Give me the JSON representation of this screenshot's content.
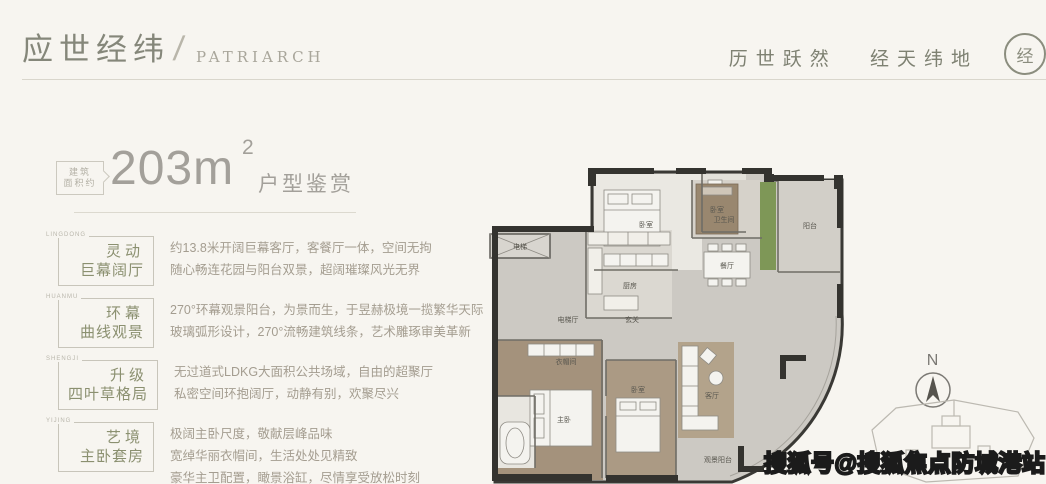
{
  "header": {
    "brand_cn": "应世经纬",
    "brand_slash": "/",
    "brand_en": "PATRIARCH",
    "slogan_part1": "历世跃然",
    "slogan_part2": "经天纬地",
    "seal_char": "经"
  },
  "area": {
    "bubble_line1": "建筑",
    "bubble_line2": "面积约",
    "value": "203m",
    "sup": "2",
    "suffix": "户型鉴赏"
  },
  "sections": [
    {
      "tag": "LINGDONG",
      "title_line1": "灵动",
      "title_line2": "巨幕阔厅",
      "desc": [
        "约13.8米开阔巨幕客厅，客餐厅一体，空间无拘",
        "随心畅连花园与阳台双景，超阔璀璨风光无界"
      ]
    },
    {
      "tag": "HUANMU",
      "title_line1": "环幕",
      "title_line2": "曲线观景",
      "desc": [
        "270°环幕观景阳台，为景而生，于昱赫极境一揽繁华天际",
        "玻璃弧形设计，270°流畅建筑线条，艺术雕琢审美革新"
      ]
    },
    {
      "tag": "SHENGJI",
      "title_line1": "升级",
      "title_line2": "四叶草格局",
      "desc": [
        "无过道式LDKG大面积公共场域，自由的超聚厅",
        "私密空间环抱阔厅，动静有别，欢聚尽兴"
      ]
    },
    {
      "tag": "YIJING",
      "title_line1": "艺境",
      "title_line2": "主卧套房",
      "desc": [
        "极阔主卧尺度，敬献层峰品味",
        "宽绰华丽衣帽间，生活处处见精致",
        "豪华主卫配置，瞰景浴缸，尽情享受放松时刻"
      ]
    }
  ],
  "floorplan": {
    "labels": {
      "bedroom_top": "卧室",
      "bath_top": "卫生间",
      "bedroom_right": "卧室",
      "balcony_right": "阳台",
      "kitchen": "厨房",
      "dining": "餐厅",
      "elevator": "电梯",
      "elevator_hall": "电梯厅",
      "foyer": "玄关",
      "living": "客厅",
      "master": "主卧",
      "cloakroom": "衣帽间",
      "bedroom_bottom": "卧室",
      "view_balcony": "观景阳台"
    },
    "compass_n": "N"
  },
  "watermark": "搜狐号@搜狐焦点防城港站",
  "colors": {
    "brand": "#85877a",
    "label_green": "#8b9070",
    "plan_brown": "#a4927c",
    "plan_green": "#7e9757",
    "background": "#f7f5f0"
  }
}
